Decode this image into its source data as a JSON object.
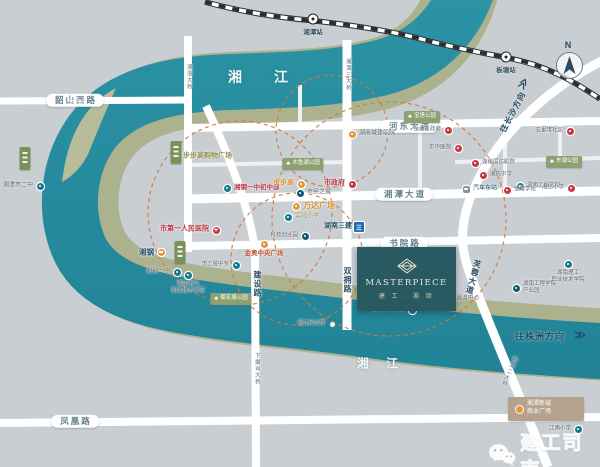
{
  "map": {
    "river_labels": [
      {
        "text": "湘  江",
        "x": 265,
        "y": 77,
        "size": 14,
        "ls": 14
      },
      {
        "text": "湘 江",
        "x": 381,
        "y": 363,
        "size": 12,
        "ls": 7
      }
    ],
    "island_label": "杨梅洲",
    "stations": [
      {
        "name": "湘潭站",
        "x": 313,
        "y": 19
      },
      {
        "name": "板塘站",
        "x": 506,
        "y": 57
      }
    ],
    "compass_label": "N",
    "directions": [
      {
        "text": "往长沙方向",
        "x": 513,
        "y": 112,
        "rot": -62,
        "size": 8,
        "chev": "≫",
        "cx": 524,
        "cy": 84,
        "crot": -62
      },
      {
        "text": "往株洲方向",
        "x": 540,
        "y": 336,
        "rot": 0,
        "size": 9,
        "chev": "≫",
        "cx": 580,
        "cy": 336,
        "crot": 0
      }
    ],
    "road_pills": [
      {
        "text": "韶山西路",
        "x": 75,
        "y": 100
      },
      {
        "text": "河东大道",
        "x": 409,
        "y": 126
      },
      {
        "text": "湘潭大道",
        "x": 404,
        "y": 194
      },
      {
        "text": "书院路",
        "x": 404,
        "y": 243
      },
      {
        "text": "凤凰路",
        "x": 75,
        "y": 421
      }
    ],
    "vertical_labels": [
      {
        "text": "湘潭大桥",
        "x": 188,
        "y": 77,
        "size": 5.5,
        "color": "#51707f",
        "bold": false,
        "rot": 0
      },
      {
        "text": "湘潭三大桥",
        "x": 347,
        "y": 75,
        "size": 5.5,
        "color": "#51707f",
        "bold": false,
        "rot": 0
      },
      {
        "text": "下摄司大桥",
        "x": 256,
        "y": 369,
        "size": 5.5,
        "color": "#51707f",
        "bold": false,
        "rot": 0
      },
      {
        "text": "湘潭二大桥",
        "x": 508,
        "y": 371,
        "size": 5.5,
        "color": "#51707f",
        "bold": false,
        "rot": 22
      },
      {
        "text": "双拥路",
        "x": 347,
        "y": 280,
        "size": 8,
        "color": "#2e5066",
        "bold": true,
        "rot": 0
      },
      {
        "text": "建设路",
        "x": 257,
        "y": 284,
        "size": 8,
        "color": "#2e5066",
        "bold": true,
        "rot": 0
      },
      {
        "text": "芙蓉大道",
        "x": 473,
        "y": 277,
        "size": 8,
        "color": "#2e5066",
        "bold": true,
        "rot": 16
      }
    ],
    "pois": [
      {
        "name": "湘潭市二中",
        "x": 40,
        "y": 186,
        "dot": "teal",
        "side": "left",
        "color": "gray",
        "size": 6,
        "bold": false
      },
      {
        "name": "步步高购物广场",
        "x": 176,
        "y": 157,
        "dot": "orange",
        "side": "right",
        "color": "olive",
        "size": 7,
        "bold": true
      },
      {
        "name": "湘钢一中初中部",
        "x": 227,
        "y": 188,
        "dot": "teal",
        "side": "right",
        "color": "red",
        "size": 6.5,
        "bold": true
      },
      {
        "name": "步步高",
        "x": 301,
        "y": 184,
        "dot": "orange",
        "side": "left",
        "color": "orange",
        "size": 7,
        "bold": true
      },
      {
        "name": "市政府",
        "x": 352,
        "y": 184,
        "dot": "red",
        "side": "left",
        "color": "red",
        "size": 7,
        "bold": true
      },
      {
        "name": "市民之家",
        "x": 300,
        "y": 193,
        "dot": "navy",
        "side": "right",
        "color": "gray",
        "size": 6,
        "bold": false
      },
      {
        "name": "万达广场",
        "x": 296,
        "y": 206,
        "dot": "orange",
        "side": "right",
        "color": "orange",
        "size": 8,
        "bold": true
      },
      {
        "name": "实验小学",
        "x": 288,
        "y": 217,
        "dot": "teal",
        "side": "right",
        "color": "olive",
        "size": 6,
        "bold": false
      },
      {
        "name": "湖南三建",
        "x": 359,
        "y": 227,
        "dot": "sq",
        "side": "left",
        "color": "navy",
        "size": 7,
        "bold": true
      },
      {
        "name": "科技创业园",
        "x": 305,
        "y": 236,
        "dot": "navy",
        "side": "left",
        "color": "gray",
        "size": 5.5,
        "bold": false
      },
      {
        "name": "市第一人民医院",
        "x": 216,
        "y": 230,
        "dot": "cross",
        "side": "left",
        "color": "red",
        "size": 7,
        "bold": true
      },
      {
        "name": "金奥中央广场",
        "x": 264,
        "y": 244,
        "dot": "orange",
        "side": "below",
        "color": "redorange",
        "size": 6.5,
        "bold": true
      },
      {
        "name": "湘钢",
        "x": 161,
        "y": 252,
        "dot": "bar",
        "side": "left",
        "color": "navy",
        "size": 7.5,
        "bold": true
      },
      {
        "name": "湘钢一中",
        "x": 177,
        "y": 272,
        "dot": "teal",
        "side": "left",
        "color": "gray",
        "size": 6,
        "bold": false
      },
      {
        "name": "湖南电气职业技术学院",
        "lines": [
          "湖南电气",
          "职业技术学院"
        ],
        "x": 188,
        "y": 275,
        "dot": "teal",
        "side": "below",
        "color": "gray",
        "size": 5.5,
        "bold": false
      },
      {
        "name": "市工贸中专",
        "x": 236,
        "y": 265,
        "dot": "teal",
        "side": "left",
        "color": "gray",
        "size": 5.5,
        "bold": false
      },
      {
        "name": "湖南城建职院",
        "x": 352,
        "y": 134,
        "dot": "orange",
        "side": "right",
        "color": "gray",
        "size": 6,
        "bold": false
      },
      {
        "name": "岳塘区政府",
        "x": 448,
        "y": 130,
        "dot": "red",
        "side": "left",
        "color": "gray",
        "size": 5.5,
        "bold": false
      },
      {
        "name": "市中医院",
        "x": 458,
        "y": 148,
        "dot": "red",
        "side": "left",
        "color": "gray",
        "size": 5.5,
        "bold": false
      },
      {
        "name": "五里堆社区",
        "x": 570,
        "y": 131,
        "dot": "red",
        "side": "left",
        "color": "gray",
        "size": 5.5,
        "bold": false
      },
      {
        "name": "湖南国防职院",
        "x": 475,
        "y": 163,
        "dot": "red",
        "side": "right",
        "color": "gray",
        "size": 5.5,
        "bold": false
      },
      {
        "name": "湘机中学",
        "x": 483,
        "y": 175,
        "dot": "red",
        "side": "right",
        "color": "gray",
        "size": 5.5,
        "bold": false
      },
      {
        "name": "湖南工程学院",
        "x": 520,
        "y": 186,
        "dot": "teal",
        "side": "right",
        "color": "gray",
        "size": 5.5,
        "bold": false
      },
      {
        "name": "汽车东站",
        "x": 466,
        "y": 189,
        "dot": "bus",
        "side": "right",
        "color": "navy",
        "size": 6,
        "bold": false
      },
      {
        "name": "宝塔学校",
        "x": 507,
        "y": 190,
        "dot": "red",
        "side": "right",
        "color": "gray",
        "size": 5.5,
        "bold": false
      },
      {
        "name": "湘纺小学",
        "x": 571,
        "y": 188,
        "dot": "red",
        "side": "left",
        "color": "gray",
        "size": 5.5,
        "bold": false
      },
      {
        "name": "社区卫生服务中心",
        "x": 428,
        "y": 299,
        "dot": "red",
        "side": "right",
        "color": "gray",
        "size": 5.5,
        "bold": false
      },
      {
        "name": "吉利汽车职院",
        "x": 412,
        "y": 310,
        "dot": "teal",
        "side": "left",
        "color": "gray",
        "size": 5.5,
        "bold": false
      },
      {
        "name": "湖南理工职院",
        "lines": [
          "湖南理工",
          "职业技术学院"
        ],
        "x": 568,
        "y": 264,
        "dot": "teal",
        "side": "below",
        "color": "gray",
        "size": 5.5,
        "bold": false
      },
      {
        "name": "湖南工程学院产业园",
        "lines": [
          "湖南工程学院",
          "产业园"
        ],
        "x": 516,
        "y": 288,
        "dot": "navy",
        "side": "right",
        "color": "gray",
        "size": 5.5,
        "bold": false
      },
      {
        "name": "江南小学",
        "x": 578,
        "y": 429,
        "dot": "teal",
        "side": "left",
        "color": "gray",
        "size": 5.5,
        "bold": false
      },
      {
        "name": "湘江风光带",
        "x": 332,
        "y": 324,
        "dot": "white",
        "side": "left",
        "color": "gray",
        "size": 5.5,
        "bold": false
      }
    ],
    "parks": [
      {
        "name": "木鱼湖公园",
        "x": 303,
        "y": 164
      },
      {
        "name": "宝塔公园",
        "x": 422,
        "y": 117
      },
      {
        "name": "东湖公园",
        "x": 564,
        "y": 162
      },
      {
        "name": "菊花塘公园",
        "x": 231,
        "y": 299
      }
    ],
    "green_buildings": [
      {
        "x": 176,
        "y": 141
      },
      {
        "x": 180,
        "y": 241
      },
      {
        "x": 25,
        "y": 147
      }
    ],
    "commercial_box": {
      "lines": [
        "湘潭新城",
        "商业广场"
      ]
    }
  },
  "project": {
    "brand": "MASTERPIECE",
    "name_cn": "建 工 · 湘 颂"
  },
  "watermark": {
    "text": "建工司南"
  },
  "colors": {
    "river": "#2a8d9f",
    "bank": "#adb28e",
    "background": "#c9ced3",
    "road": "#ffffff",
    "ring_dash": "#cf7a3e",
    "accent_orange": "#e09a3c",
    "accent_teal": "#14798c",
    "accent_red": "#c23a45",
    "project_bg": "#2a5a61"
  }
}
